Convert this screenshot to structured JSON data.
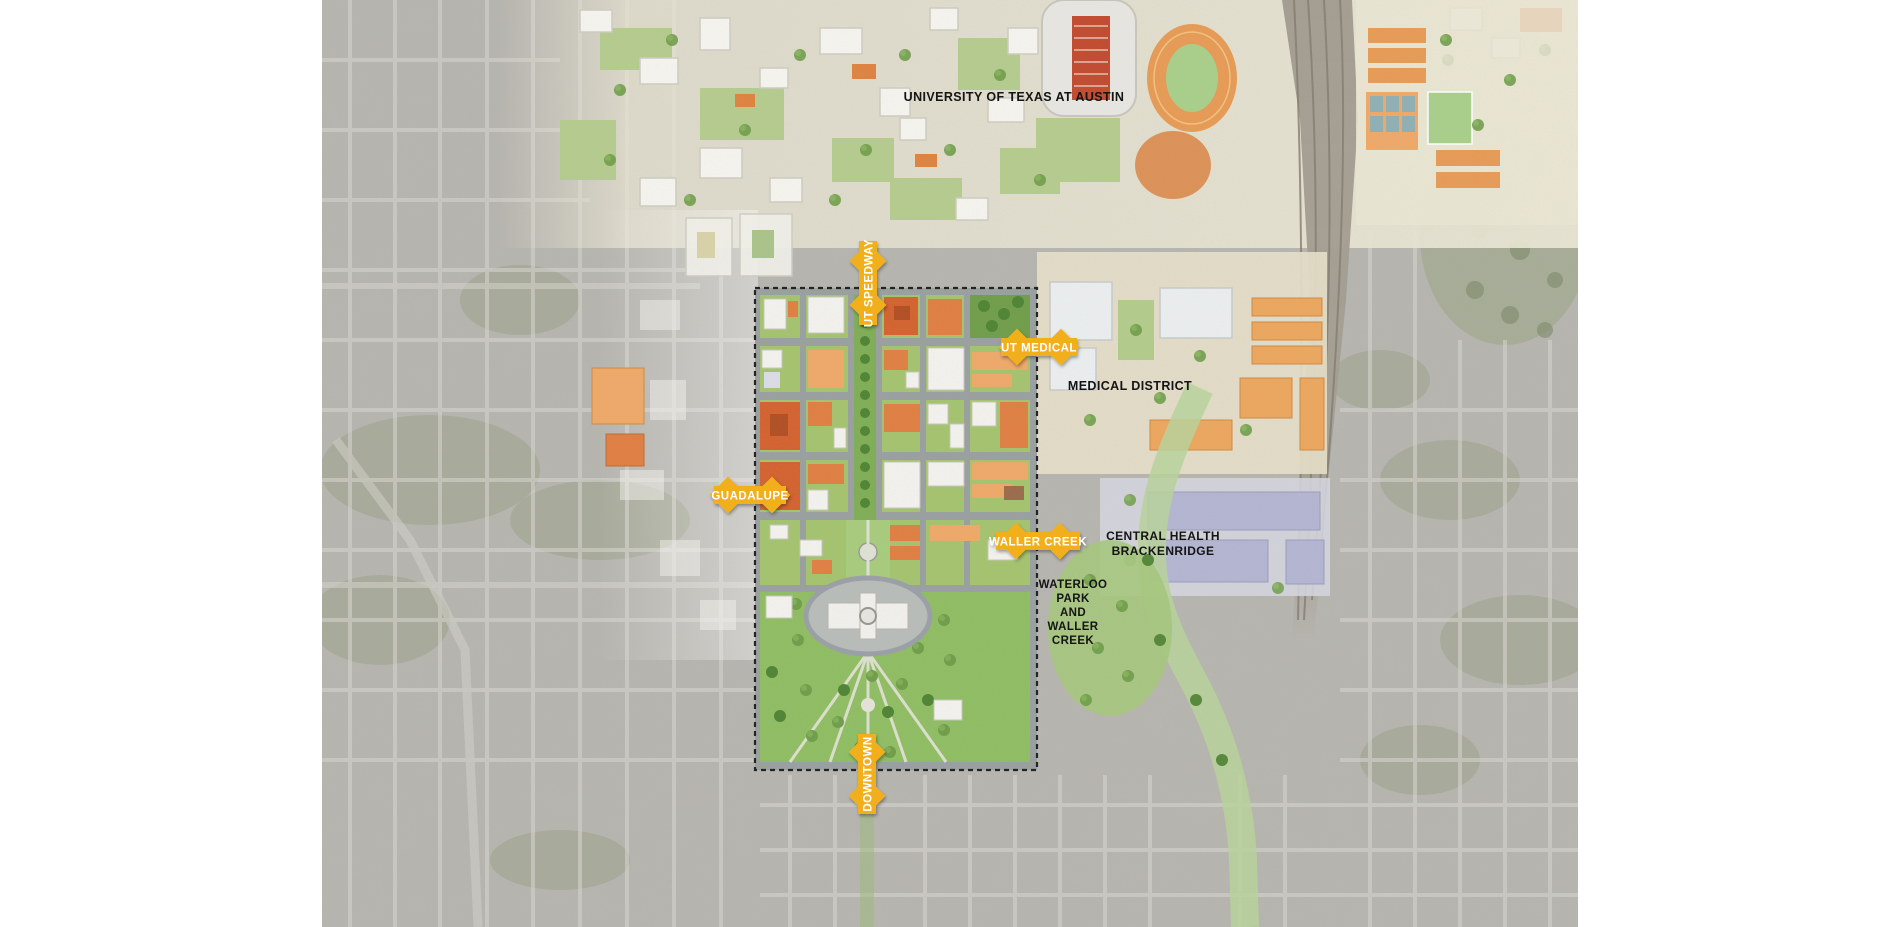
{
  "map": {
    "title": "Texas Capitol Complex master plan context map, Austin",
    "labels": {
      "university": "UNIVERSITY OF TEXAS AT AUSTIN",
      "medical_district": "MEDICAL DISTRICT",
      "central_health": {
        "line1": "CENTRAL HEALTH",
        "line2": "BRACKENRIDGE"
      },
      "waterloo": {
        "line1": "WATERLOO",
        "line2": "PARK",
        "line3": "AND",
        "line4": "WALLER",
        "line5": "CREEK"
      }
    },
    "arrows": [
      {
        "id": "ut-speedway",
        "label": "UT SPEEDWAY",
        "orientation": "vertical"
      },
      {
        "id": "ut-medical",
        "label": "UT MEDICAL",
        "orientation": "horizontal"
      },
      {
        "id": "guadalupe",
        "label": "GUADALUPE",
        "orientation": "horizontal"
      },
      {
        "id": "waller-creek",
        "label": "WALLER CREEK",
        "orientation": "horizontal"
      },
      {
        "id": "downtown",
        "label": "DOWNTOWN",
        "orientation": "vertical"
      }
    ],
    "colors": {
      "arrow_yellow": "#F2AF1D",
      "label_black": "#141414",
      "plan_orange_dark": "#D4622E",
      "plan_orange": "#E07F42",
      "plan_orange_light": "#EFA968",
      "lawn_green": "#8FBE62",
      "tree_green": "#5D8F3E",
      "street_gray": "#9AA0A0",
      "aerial_gray": "#B7B5AE",
      "medical_tan": "#EDA75E",
      "brackenridge_lavender": "#B4B6D2",
      "capitol_white": "#F2F1EE"
    }
  }
}
